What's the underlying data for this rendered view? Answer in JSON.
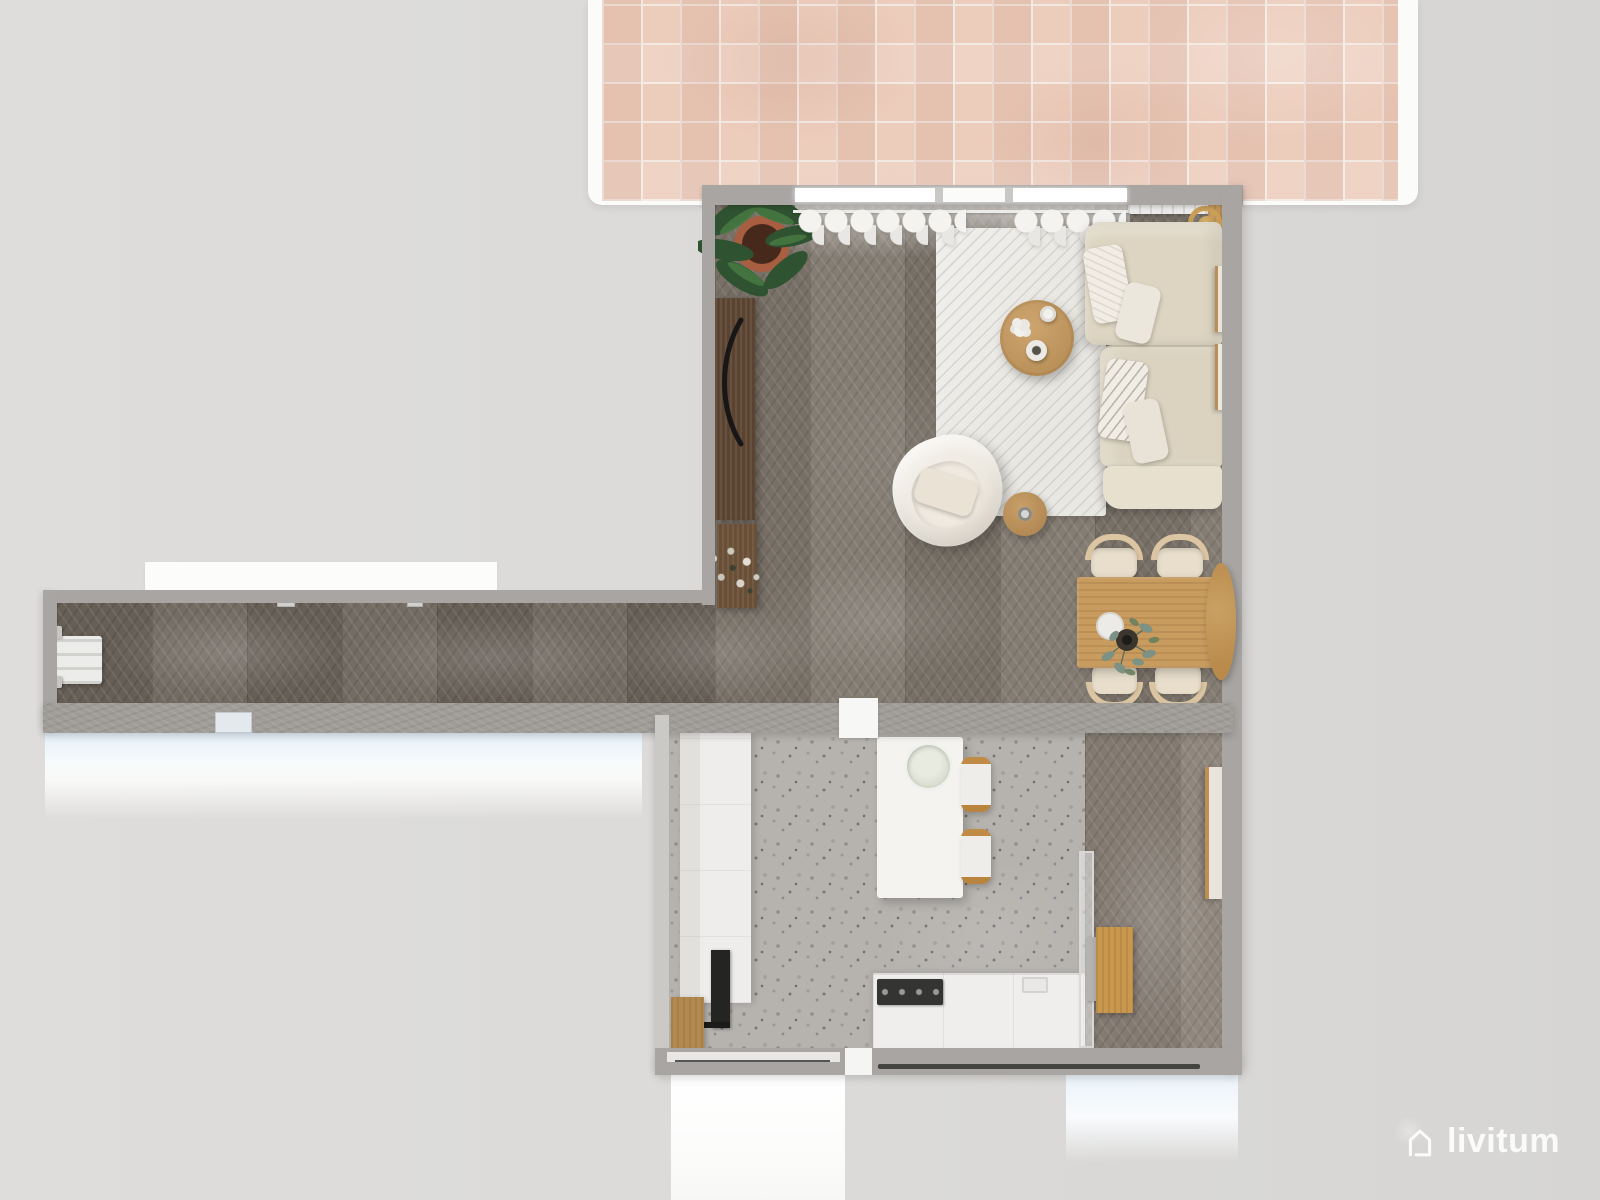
{
  "watermark": {
    "text": "livitum",
    "icon": "house-outline-icon",
    "color": "#fdfdfd"
  },
  "scene": {
    "type": "3d-floorplan-top-down-render",
    "rooms": [
      {
        "id": "terrace",
        "label": "tiled terrace",
        "floor": "pink square tiles"
      },
      {
        "id": "living-dining-room",
        "label": "living and dining room",
        "floor": "dark herringbone wood"
      },
      {
        "id": "hallway",
        "label": "long hallway",
        "floor": "dark herringbone wood"
      },
      {
        "id": "kitchen",
        "label": "kitchen",
        "floor": "gray terrazzo"
      },
      {
        "id": "side-room",
        "label": "side room",
        "floor": "dark herringbone wood"
      }
    ],
    "furniture": [
      "potted-plant",
      "media-cabinet",
      "curtains",
      "radiator",
      "gold-floor-lamp",
      "area-rug",
      "round-coffee-table",
      "sectional-sofa",
      "throw-pillows",
      "wall-art",
      "armchair",
      "round-side-table",
      "dining-table",
      "dining-chairs",
      "centerpiece-plant",
      "hallway-radiator",
      "kitchen-tall-cabinets",
      "oven",
      "kitchen-island",
      "sink-bowl",
      "bar-stools",
      "kitchen-counter",
      "cooktop",
      "glass-partition",
      "wood-plank",
      "leaning-mirror"
    ]
  },
  "palette": {
    "background": "#dbdad8",
    "wall": "#a8a5a2",
    "concrete": "#a09d99",
    "wood_floor": "#7e766c",
    "wood_floor_dark": "#6c645b",
    "wood_floor_light": "#8a8177",
    "terrazzo": "#b6b3af",
    "tile_pink": "#ecccbb",
    "tile_grout": "#f3e9e3",
    "sofa_beige": "#ddd5c2",
    "wood_warm": "#c89b5f",
    "wood_dark": "#5a4330",
    "white_furniture": "#f2f1ee",
    "glow_blue": "#e3eef7",
    "gold": "#c99f58",
    "logo_white": "#fdfdfd"
  }
}
